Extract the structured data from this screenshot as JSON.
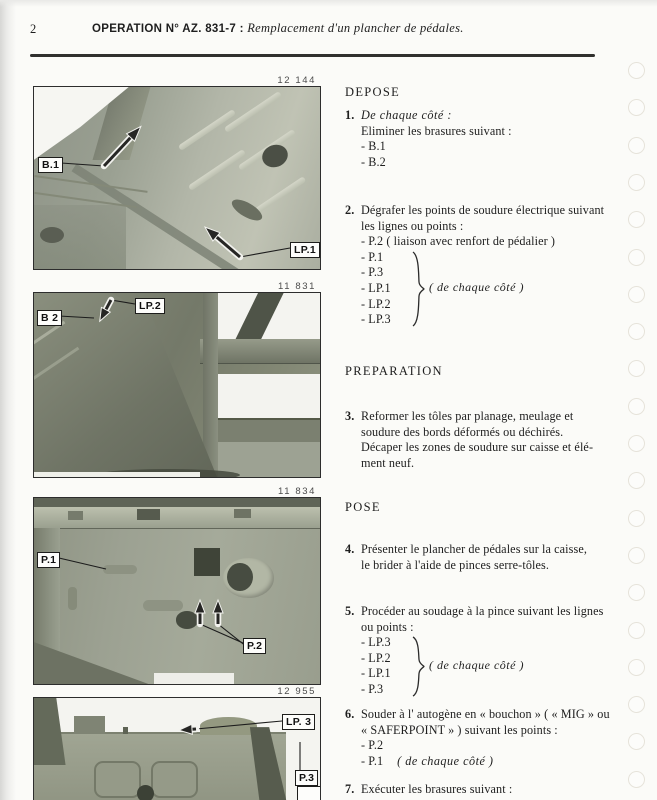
{
  "page": {
    "number": "2",
    "title_bold": "OPERATION N° AZ. 831-7 : ",
    "title_italic": "Remplacement d'un plancher de pédales."
  },
  "figures": [
    {
      "number": "12 144",
      "label_a": "B.1",
      "label_b": "LP.1"
    },
    {
      "number": "11 831",
      "label_a": "B 2",
      "label_b": "LP.2"
    },
    {
      "number": "11 834",
      "label_a": "P.1",
      "label_b": "P.2"
    },
    {
      "number": "12 955",
      "label_a": "LP. 3",
      "label_b": "P.3"
    }
  ],
  "instructions": [
    {
      "type": "heading",
      "text": "DEPOSE"
    },
    {
      "type": "step",
      "num": "1.",
      "lines": [
        {
          "t": "De chaque côté :",
          "i": true
        },
        {
          "t": "Eliminer les brasures suivant :"
        },
        {
          "t": "- B.1"
        },
        {
          "t": "- B.2"
        }
      ]
    },
    {
      "type": "step",
      "num": "2.",
      "lines": [
        {
          "t": "Dégrafer les points de soudure électrique suivant"
        },
        {
          "t": "les lignes ou points :"
        },
        {
          "t": "- P.2 ( liaison avec renfort de pédalier )"
        }
      ],
      "brace_items": [
        "- P.1",
        "- P.3",
        "- LP.1",
        "- LP.2",
        "- LP.3"
      ],
      "brace_note": "( de chaque côté )"
    },
    {
      "type": "heading",
      "text": "PREPARATION"
    },
    {
      "type": "step",
      "num": "3.",
      "lines": [
        {
          "t": "Reformer les tôles par planage, meulage et"
        },
        {
          "t": "soudure des bords déformés ou déchirés."
        },
        {
          "t": "Décaper les zones de soudure sur caisse et élé-"
        },
        {
          "t": "ment neuf."
        }
      ]
    },
    {
      "type": "heading",
      "text": "POSE"
    },
    {
      "type": "step",
      "num": "4.",
      "lines": [
        {
          "t": "Présenter le plancher de pédales sur la caisse,"
        },
        {
          "t": "le brider à l'aide de pinces serre-tôles."
        }
      ]
    },
    {
      "type": "step",
      "num": "5.",
      "lines": [
        {
          "t": "Procéder au soudage à la pince suivant les lignes"
        },
        {
          "t": "ou points :"
        }
      ],
      "brace_items": [
        "- LP.3",
        "- LP.2",
        "- LP.1",
        "- P.3"
      ],
      "brace_note": "( de chaque côté )"
    },
    {
      "type": "step",
      "num": "6.",
      "lines": [
        {
          "t": "Souder à l' autogène en « bouchon » ( « MIG » ou"
        },
        {
          "t": "« SAFERPOINT » ) suivant les points :"
        },
        {
          "t": "- P.2"
        },
        {
          "t": "- P.1",
          "note": "( de chaque côté )"
        }
      ]
    },
    {
      "type": "step",
      "num": "7.",
      "lines": [
        {
          "t": "Exécuter les brasures suivant :"
        },
        {
          "t": "- B.1",
          "note": "( de chaque côté )"
        }
      ]
    }
  ]
}
